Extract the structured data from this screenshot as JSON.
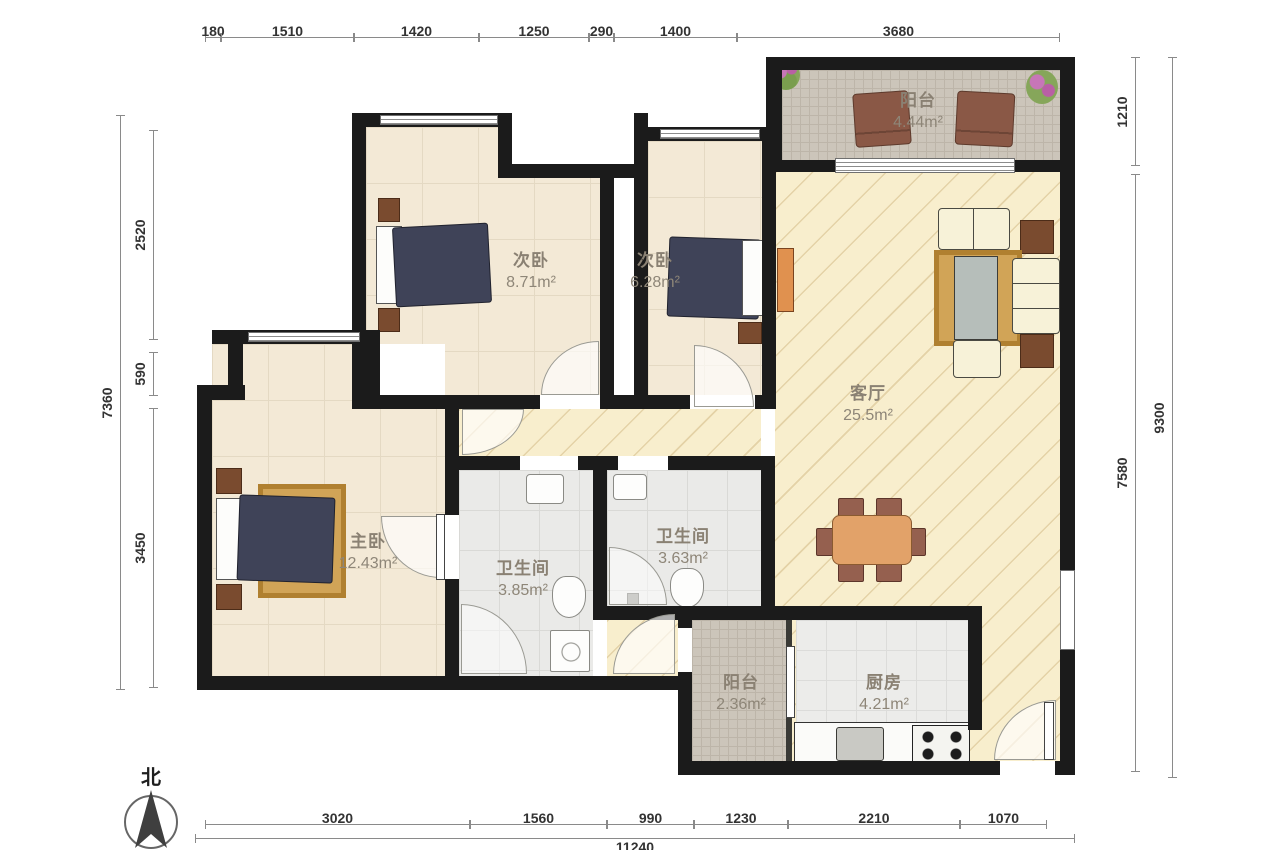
{
  "compass": {
    "label": "北"
  },
  "rooms": [
    {
      "id": "balcony-top",
      "name": "阳台",
      "area": "4.44m²"
    },
    {
      "id": "bedroom-2",
      "name": "次卧",
      "area": "8.71m²"
    },
    {
      "id": "bedroom-3",
      "name": "次卧",
      "area": "6.28m²"
    },
    {
      "id": "living-room",
      "name": "客厅",
      "area": "25.5m²"
    },
    {
      "id": "master-bedroom",
      "name": "主卧",
      "area": "12.43m²"
    },
    {
      "id": "bathroom-1",
      "name": "卫生间",
      "area": "3.85m²"
    },
    {
      "id": "bathroom-2",
      "name": "卫生间",
      "area": "3.63m²"
    },
    {
      "id": "balcony-bottom",
      "name": "阳台",
      "area": "2.36m²"
    },
    {
      "id": "kitchen",
      "name": "厨房",
      "area": "4.21m²"
    }
  ],
  "dimensions": {
    "top": [
      "180",
      "1510",
      "1420",
      "1250",
      "290",
      "1400",
      "3680"
    ],
    "bottom": [
      "3020",
      "1560",
      "990",
      "1230",
      "2210",
      "1070"
    ],
    "bottom_total": "11240",
    "left": [
      "2520",
      "590",
      "3450"
    ],
    "left_total": "7360",
    "right": [
      "1210",
      "7580"
    ],
    "right_total": "9300"
  },
  "colors": {
    "wall": "#1b1b1b",
    "bedroom_floor": "#f3e9d6",
    "living_floor": "#f8eecd",
    "bath_floor": "#eaeae8",
    "balcony_floor": "#ccc5ba",
    "bed": "#3f4358",
    "wood": "#7a4b2f",
    "rug": "#c8953e",
    "dining_table": "#e2a269"
  }
}
